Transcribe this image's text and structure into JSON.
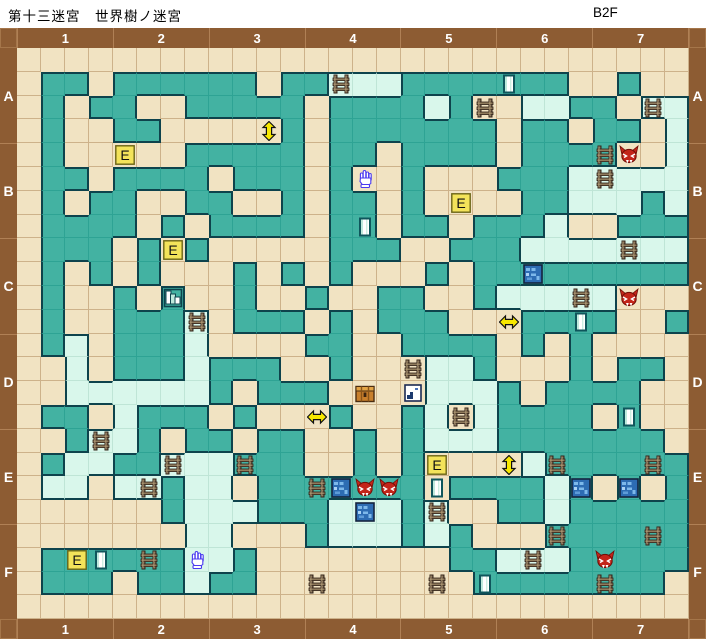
{
  "title": "第十三迷宮　世界樹ノ迷宮",
  "floor": "B2F",
  "axis": {
    "col_labels": [
      "1",
      "2",
      "3",
      "4",
      "5",
      "6",
      "7"
    ],
    "row_labels": [
      "A",
      "B",
      "C",
      "D",
      "E",
      "F"
    ]
  },
  "colors": {
    "frame_brown": "#8d5c33",
    "label_text": "#ffffff",
    "corridor_tan": "#f1e3c2",
    "wall_teal": "#43b2a2",
    "special_floor_mint": "#d9f7eb",
    "wall_outline": "#0e434c",
    "grid_line_tan": "#cdb28a",
    "grid_line_teal": "#2ea394",
    "grid_line_mint": "#bfe5d6",
    "event_yellow": "#f3e35a",
    "arrow_yellow": "#f7e800",
    "foe_red": "#c3251a",
    "ladder_brown": "#7d6950",
    "blue_tile": "#2d6cb3",
    "chest_orange": "#c87f2c"
  },
  "grid": {
    "cols": 28,
    "rows": 24,
    "cell_types": {
      "t": "corridor",
      "g": "wall-block",
      "c": "special-floor"
    },
    "rows_map": [
      "tttttttttttttttttttttttttttt",
      "tggtggggggtggcccgggggggttgtt",
      "tgtggttgggggtggggcgttccggtcc",
      "tgttggtttttgtgggggggtggtggtc",
      "tgtttttgggggtggtggggtggggttc",
      "tggtggggtgggtgttgtttgggccccc",
      "tgtggttggttgtggtgttttggcccgc",
      "tggggtgtggggtggtggtgggcttggg",
      "tgggtgtgtttttgggttgggccccccc",
      "tgtgtgtttgtgtgtttgtggggggggg",
      "tgttgtgttgttgttggttgcccccttt",
      "tgttgggctgggtgtgggtttggggttg",
      "tgctgggcttttggttggggtgtgtttt",
      "ttctgggcgggttgtttccgtttgtggt",
      "ttccccccgtgggttttcccgtggggtt",
      "tggtcgggtgtttgttgctcggggtgtt",
      "ttgccgtggtggttgtgcccgggggggt",
      "tgccggcccgggttgtgttttcgggggg",
      "tcctccgcctgggggggtggggcgtgtg",
      "ttttttgcccgggcccgcttggcggggg",
      "tttttttcctttgcccgcgtttgggggg",
      "tggggggccgttttttttggcccggggg",
      "tgggtggcggtttttttttggggggggt",
      "tttttttttttttttttttttttttttt"
    ]
  },
  "icons": [
    {
      "type": "ladder",
      "row": 2,
      "col": 14
    },
    {
      "type": "door",
      "row": 2,
      "col": 21
    },
    {
      "type": "ladder",
      "row": 3,
      "col": 20
    },
    {
      "type": "ladder",
      "row": 3,
      "col": 27
    },
    {
      "type": "arrow-vertical",
      "row": 4,
      "col": 11
    },
    {
      "type": "event",
      "row": 5,
      "col": 5,
      "label": "E"
    },
    {
      "type": "ladder",
      "row": 5,
      "col": 25
    },
    {
      "type": "foe",
      "row": 5,
      "col": 26
    },
    {
      "type": "hand",
      "row": 6,
      "col": 15
    },
    {
      "type": "ladder",
      "row": 6,
      "col": 25
    },
    {
      "type": "event",
      "row": 7,
      "col": 19,
      "label": "E"
    },
    {
      "type": "door",
      "row": 8,
      "col": 15
    },
    {
      "type": "event",
      "row": 9,
      "col": 7,
      "label": "E"
    },
    {
      "type": "ladder",
      "row": 9,
      "col": 26
    },
    {
      "type": "blue-tile",
      "row": 10,
      "col": 22
    },
    {
      "type": "steps",
      "row": 11,
      "col": 7
    },
    {
      "type": "ladder",
      "row": 11,
      "col": 24
    },
    {
      "type": "foe",
      "row": 11,
      "col": 26
    },
    {
      "type": "ladder",
      "row": 12,
      "col": 8
    },
    {
      "type": "arrow-horizontal",
      "row": 12,
      "col": 21
    },
    {
      "type": "door",
      "row": 12,
      "col": 24
    },
    {
      "type": "ladder",
      "row": 14,
      "col": 17
    },
    {
      "type": "chest",
      "row": 15,
      "col": 15
    },
    {
      "type": "note",
      "row": 15,
      "col": 17
    },
    {
      "type": "arrow-horizontal",
      "row": 16,
      "col": 13
    },
    {
      "type": "ladder",
      "row": 16,
      "col": 19
    },
    {
      "type": "door",
      "row": 16,
      "col": 26
    },
    {
      "type": "ladder",
      "row": 17,
      "col": 4
    },
    {
      "type": "ladder",
      "row": 18,
      "col": 7
    },
    {
      "type": "ladder",
      "row": 18,
      "col": 10
    },
    {
      "type": "event",
      "row": 18,
      "col": 18,
      "label": "E"
    },
    {
      "type": "arrow-vertical",
      "row": 18,
      "col": 21
    },
    {
      "type": "ladder",
      "row": 18,
      "col": 23
    },
    {
      "type": "ladder",
      "row": 18,
      "col": 27
    },
    {
      "type": "ladder",
      "row": 19,
      "col": 6
    },
    {
      "type": "ladder",
      "row": 19,
      "col": 13
    },
    {
      "type": "blue-tile",
      "row": 19,
      "col": 14
    },
    {
      "type": "foe",
      "row": 19,
      "col": 15
    },
    {
      "type": "foe",
      "row": 19,
      "col": 16
    },
    {
      "type": "door",
      "row": 19,
      "col": 18
    },
    {
      "type": "blue-tile",
      "row": 19,
      "col": 24
    },
    {
      "type": "blue-tile",
      "row": 19,
      "col": 26
    },
    {
      "type": "blue-tile",
      "row": 20,
      "col": 15
    },
    {
      "type": "ladder",
      "row": 20,
      "col": 18
    },
    {
      "type": "ladder",
      "row": 21,
      "col": 23
    },
    {
      "type": "ladder",
      "row": 21,
      "col": 27
    },
    {
      "type": "event",
      "row": 22,
      "col": 3,
      "label": "E"
    },
    {
      "type": "door",
      "row": 22,
      "col": 4
    },
    {
      "type": "ladder",
      "row": 22,
      "col": 6
    },
    {
      "type": "hand",
      "row": 22,
      "col": 8
    },
    {
      "type": "ladder",
      "row": 22,
      "col": 22
    },
    {
      "type": "foe",
      "row": 22,
      "col": 25
    },
    {
      "type": "ladder",
      "row": 23,
      "col": 13
    },
    {
      "type": "ladder",
      "row": 23,
      "col": 18
    },
    {
      "type": "door",
      "row": 23,
      "col": 20
    },
    {
      "type": "ladder",
      "row": 23,
      "col": 25
    }
  ]
}
